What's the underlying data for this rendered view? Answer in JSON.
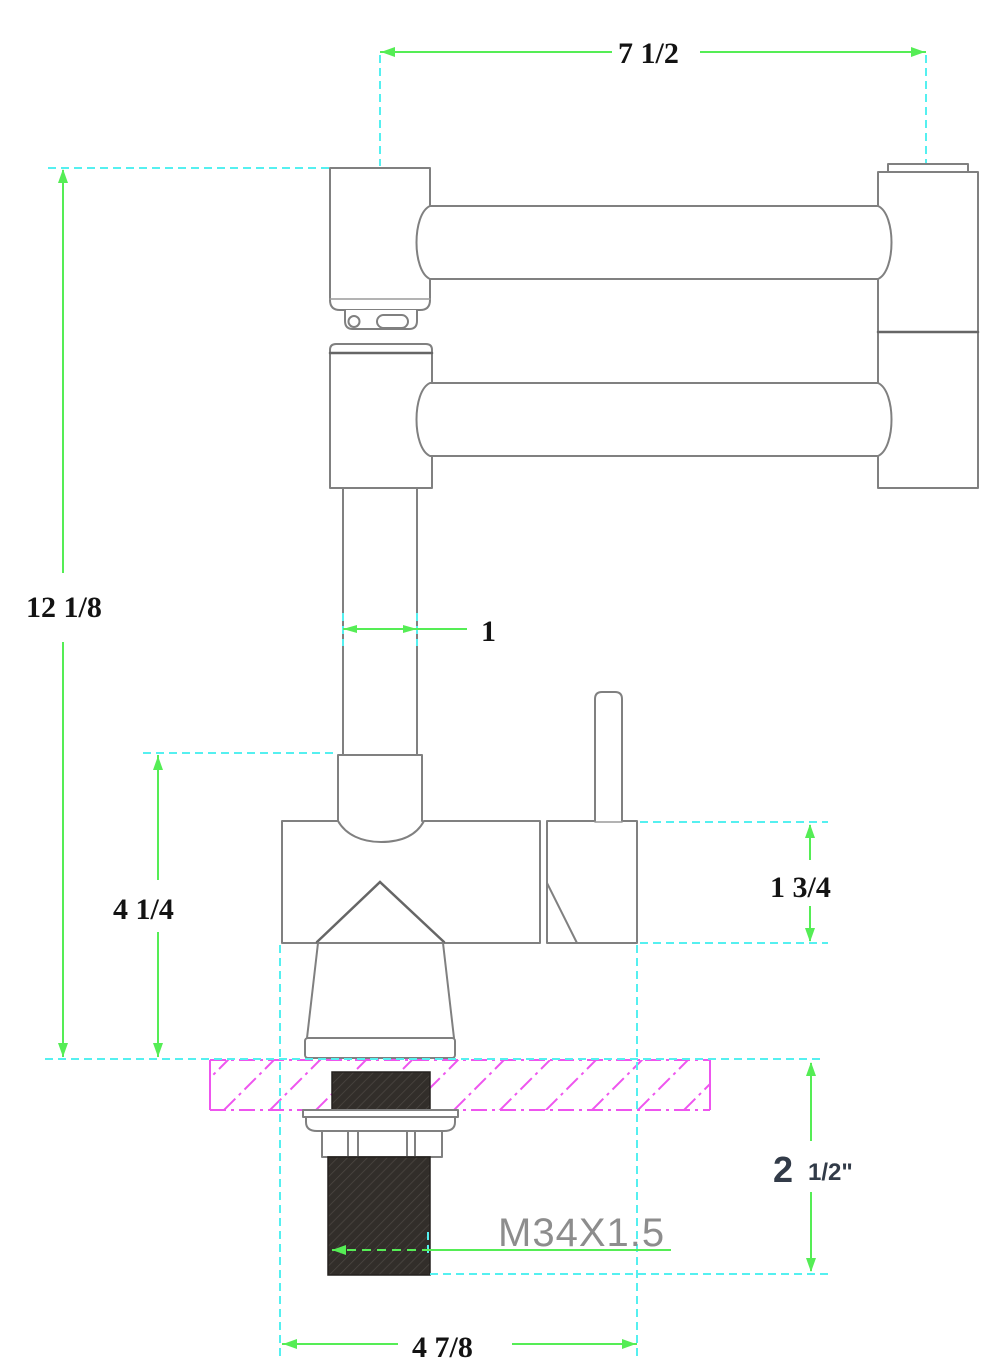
{
  "meta": {
    "subject": "Pot filler faucet technical drawing, side elevation with dimensions"
  },
  "colors": {
    "dim": "#55ed55",
    "ext": "#55f0f0",
    "hatch": "#ee55ee",
    "outline": "#808080",
    "label": "#131313",
    "thread-label": "#8d8d8d",
    "inch-label": "#323b48",
    "dark-part": "#322e2a",
    "dark-part-line": "#4e4944"
  },
  "labels": {
    "arm_reach": "7 1/2",
    "overall_height": "12 1/8",
    "pipe_width": "1",
    "body_drop": "4 1/4",
    "valve_height": "1 3/4",
    "deck_max_whole": "2",
    "deck_max_frac": "1/2\"",
    "thread_spec": "M34X1.5",
    "base_span": "4 7/8"
  }
}
